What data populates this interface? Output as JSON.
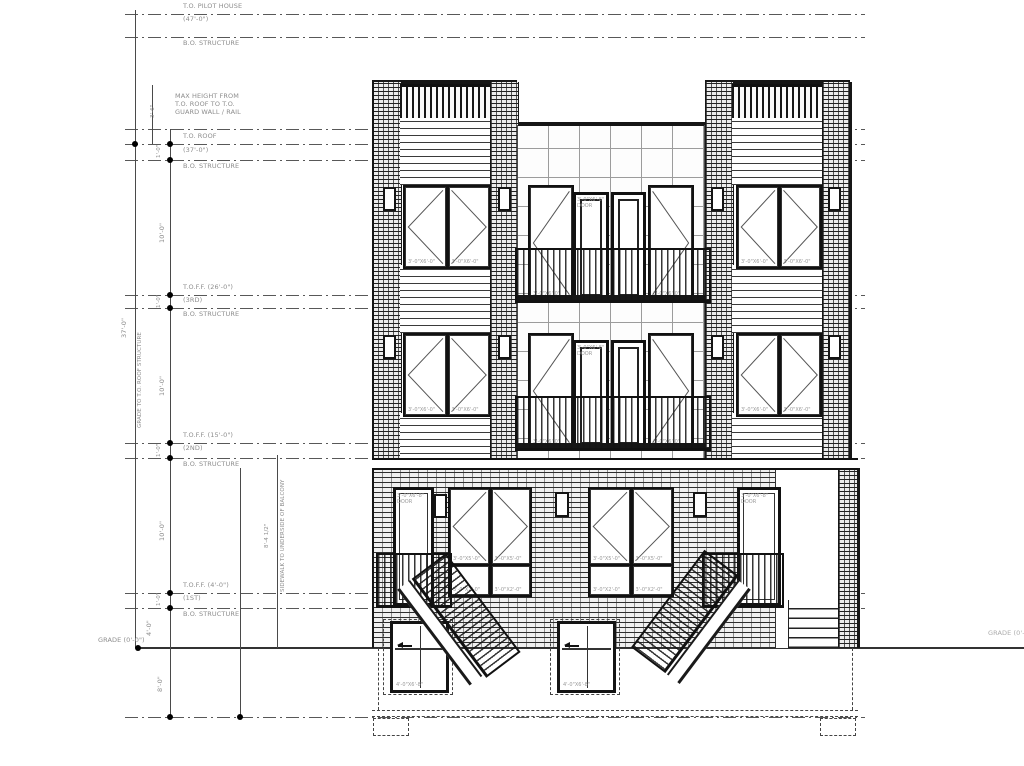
{
  "drawing_type": "building front elevation",
  "colors": {
    "line": "#1a1a1a",
    "datum_line": "#585858",
    "annotation_text": "#8d8d8d",
    "background": "#ffffff"
  },
  "datums": {
    "pilot": {
      "label": "T.O. PILOT HOUSE",
      "value": "(47'-0\")"
    },
    "bos1": {
      "label": "B.O. STRUCTURE"
    },
    "roof": {
      "label": "T.O. ROOF",
      "value": "(37'-0\")"
    },
    "bos2": {
      "label": "B.O. STRUCTURE"
    },
    "ff3": {
      "label": "T.O.F.F. (26'-0\")",
      "value": "(3RD)"
    },
    "bos3": {
      "label": "B.O. STRUCTURE"
    },
    "ff2": {
      "label": "T.O.F.F. (15'-0\")",
      "value": "(2ND)"
    },
    "bos4": {
      "label": "B.O. STRUCTURE"
    },
    "ff1": {
      "label": "T.O.F.F. (4'-0\")",
      "value": "(1ST)"
    },
    "bos5": {
      "label": "B.O. STRUCTURE"
    },
    "grade_left": "GRADE (0'-0\")",
    "grade_right": "GRADE (0'-0\")"
  },
  "notes": {
    "max_height_1": "MAX HEIGHT FROM",
    "max_height_2": "T.O. ROOF TO T.O.",
    "max_height_3": "GUARD WALL / RAIL"
  },
  "dims": {
    "overall": "37'-0\"",
    "grade_to_roof": "GRADE TO T.O. ROOF STRUCTURE",
    "guard": "3'-6\"",
    "floor": "10'-0\"",
    "plenum": "1'-0\"",
    "foundation": "4'-0\"",
    "below_grade": "8'-0\"",
    "sidewalk_label": "SIDEWALK TO UNDERSIDE OF BALCONY",
    "sidewalk_value": "8'-4 1/2\""
  },
  "openings": {
    "tower_window": "3'-0\"X6'-0\"",
    "balcony_window": "3'-0\"X6'-0\"",
    "balcony_door_size": "3'-0\"X6'-8\"",
    "balcony_door_word": "DOOR",
    "entry_door_size": "3'-0\"X6'-8\"",
    "entry_door_word": "DOOR",
    "first_floor_window": "3'-0\"X5'-0\"",
    "first_floor_transom": "3'-0\"X2'-0\"",
    "basement_door": "4'-0\"X6'-8\""
  }
}
